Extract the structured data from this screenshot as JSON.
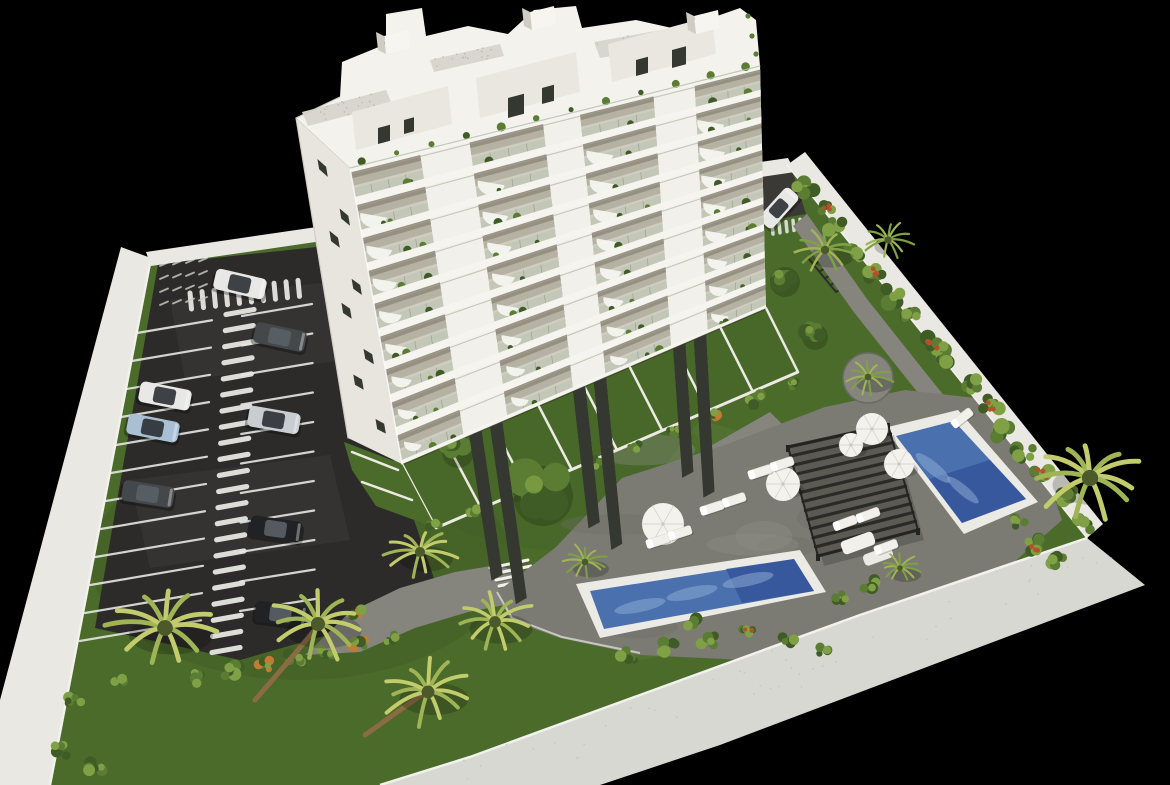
{
  "meta": {
    "type": "3d-architectural-rendering",
    "view": "aerial-axonometric",
    "subject": "white residential apartment building with landscaped gardens, two swimming pools, sun deck with pergola and a walled parking lot",
    "background": "#000000",
    "canvas": {
      "width": 1170,
      "height": 785
    }
  },
  "colors": {
    "background": "#000000",
    "grass": "#4b6b2b",
    "grass_light": "#567733",
    "grass_dark": "#3a5522",
    "asphalt": "#2c2b29",
    "asphalt_light": "#3a3935",
    "marking": "#e6e6e2",
    "path": "#85857e",
    "deck": "#7b7b74",
    "deck_light": "#8f8f88",
    "wall_top": "#e9e8e2",
    "wall_side": "#cdccc6",
    "wall_bright": "#f2f1eb",
    "wall_bottom": "#d8d8d3",
    "building": "#f1f0ea",
    "building_shade": "#e7e5de",
    "slab": "#f5f4ef",
    "balcony_floor": "#cfcdc0",
    "balcony_shadow": "#8e897b",
    "balcony_glass": "#b9c2ae",
    "window": "#343830",
    "roof_deck": "#d8d6ce",
    "speckle": "#bbb9b0",
    "pool_coping": "#eceae4",
    "water": "#4b70ae",
    "water_deep": "#35539b",
    "water_light": "#8fb0d6",
    "pergola": "#2a2a27",
    "pergola_base": "#5a5a52",
    "umbrella": "#f3f2ed",
    "lounger": "#f1f0ea",
    "foliage_dark": "#3f5c26",
    "foliage": "#5a7c33",
    "foliage_light": "#7fa044",
    "palm": "#9fb455",
    "palm_light": "#c2cc6d",
    "flower_red": "#b5502a",
    "flower_orange": "#c47a33",
    "trunk": "#8a6b42",
    "car_white": "#e8e8e6",
    "car_silver": "#c9cdd1",
    "car_blue": "#a9c0d4",
    "car_dark": "#44484b",
    "car_black": "#202226",
    "car_glass": "#2b2f33"
  },
  "counts": {
    "building_floors": 9,
    "balcony_columns": 4,
    "pools": 2,
    "cars": 9,
    "umbrellas": 5,
    "sun_loungers": 10,
    "palm_trees": 11,
    "pergolas": 1,
    "parking_rows": 2
  },
  "cars": [
    {
      "id": 1,
      "color_key": "car_white",
      "location": "entrance lane"
    },
    {
      "id": 2,
      "color_key": "car_dark",
      "location": "right row"
    },
    {
      "id": 3,
      "color_key": "car_white",
      "location": "left row"
    },
    {
      "id": 4,
      "color_key": "car_blue",
      "location": "left row"
    },
    {
      "id": 5,
      "color_key": "car_silver",
      "location": "right row"
    },
    {
      "id": 6,
      "color_key": "car_dark",
      "location": "left row"
    },
    {
      "id": 7,
      "color_key": "car_black",
      "location": "right row"
    },
    {
      "id": 8,
      "color_key": "car_black",
      "location": "right row"
    },
    {
      "id": 9,
      "color_key": "car_white",
      "location": "driveway beside building"
    }
  ]
}
